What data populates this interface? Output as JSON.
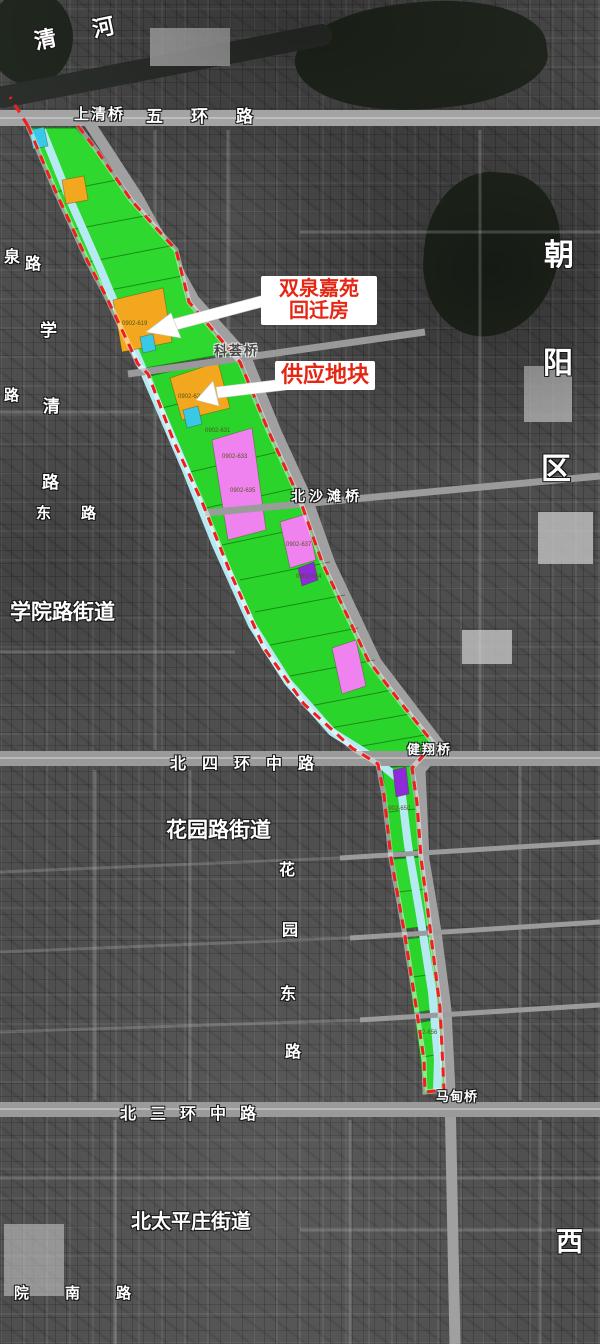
{
  "annotations": {
    "resettlement": {
      "line1": "双泉嘉苑",
      "line2": "回迁房"
    },
    "supply": "供应地块"
  },
  "districts": {
    "chaoyang": [
      "朝",
      "阳",
      "区"
    ],
    "xicheng_partial": "西"
  },
  "subdistricts": {
    "xueyuanlu": "学院路街道",
    "huayuanlu": "花园路街道",
    "beitaipingzhuang": "北太平庄街道"
  },
  "water": {
    "qinghe": [
      "清",
      "河"
    ]
  },
  "roads": {
    "wuhuan": "五环路",
    "shangqing_bridge": "上清桥",
    "quanlu_partial": [
      "泉",
      "路"
    ],
    "xueqing": [
      "学",
      "清",
      "路"
    ],
    "lu_partial": "路",
    "donglu_partial": "东路",
    "kehui_bridge": "科荟桥",
    "beishatan_bridge": "北沙滩桥",
    "beisihuan": "北四环中路",
    "jianxiang_bridge": "健翔桥",
    "huayuandong": [
      "花",
      "园",
      "东",
      "路"
    ],
    "beisanhuan": "北三环中路",
    "madian_bridge": "马甸桥",
    "yuannan": "院南路"
  },
  "parcels": {
    "codes": [
      "0902-619",
      "0902-626",
      "0902-631",
      "0902-633",
      "0902-635",
      "0902-637",
      "0902-634",
      "0902-650",
      "0902-656"
    ]
  },
  "colors": {
    "greenbelt": "#2bd42b",
    "supply_orange": "#f2a71e",
    "pink": "#ef82ef",
    "purple": "#8d2bd9",
    "water_cyan": "#b5eaf3",
    "boundary_red": "#f21d1d",
    "callout_red": "#e42613"
  }
}
